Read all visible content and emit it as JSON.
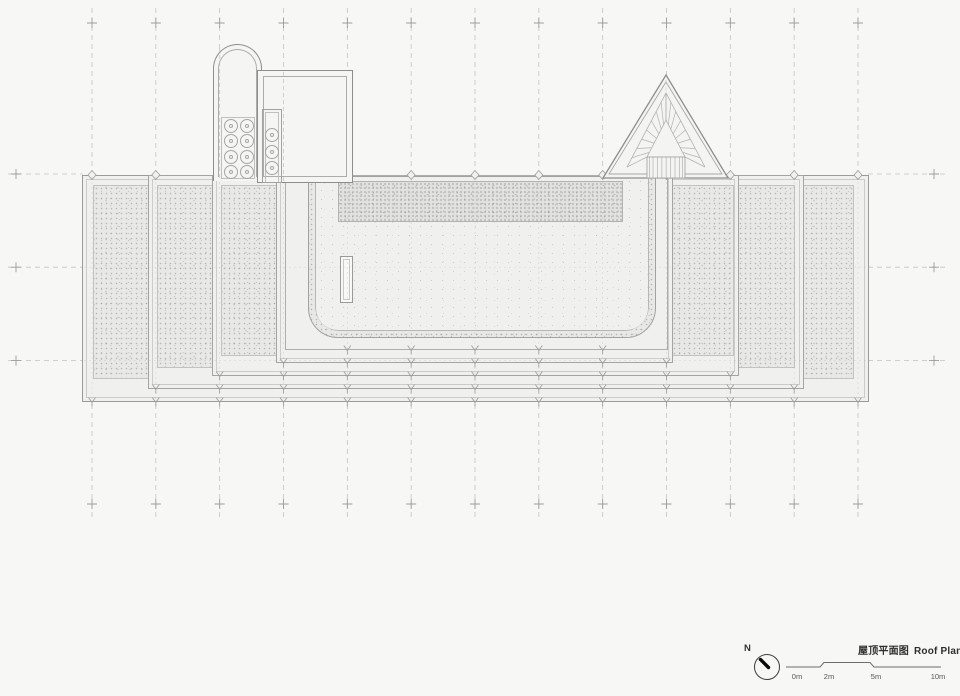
{
  "drawing_title": {
    "cn": "屋顶平面图",
    "en": "Roof Plan"
  },
  "compass": {
    "label": "N"
  },
  "scale_bar": {
    "labels": [
      "0m",
      "2m",
      "5m",
      "10m"
    ]
  },
  "colors": {
    "paper": "#f7f7f6",
    "slab_fill": "#f0f0ee",
    "texture_fill": "#e8e8e6",
    "upper_deck_fill": "#e1e1df",
    "structure_fill": "#f5f5f4",
    "drawing_line": "#a4a4a2",
    "grid_line": "#c3c3c1",
    "grid_cross": "#9c9c9a",
    "title_text": "#2e2e2e",
    "scale_text": "#555555",
    "compass_needle": "#0a0a0a"
  }
}
